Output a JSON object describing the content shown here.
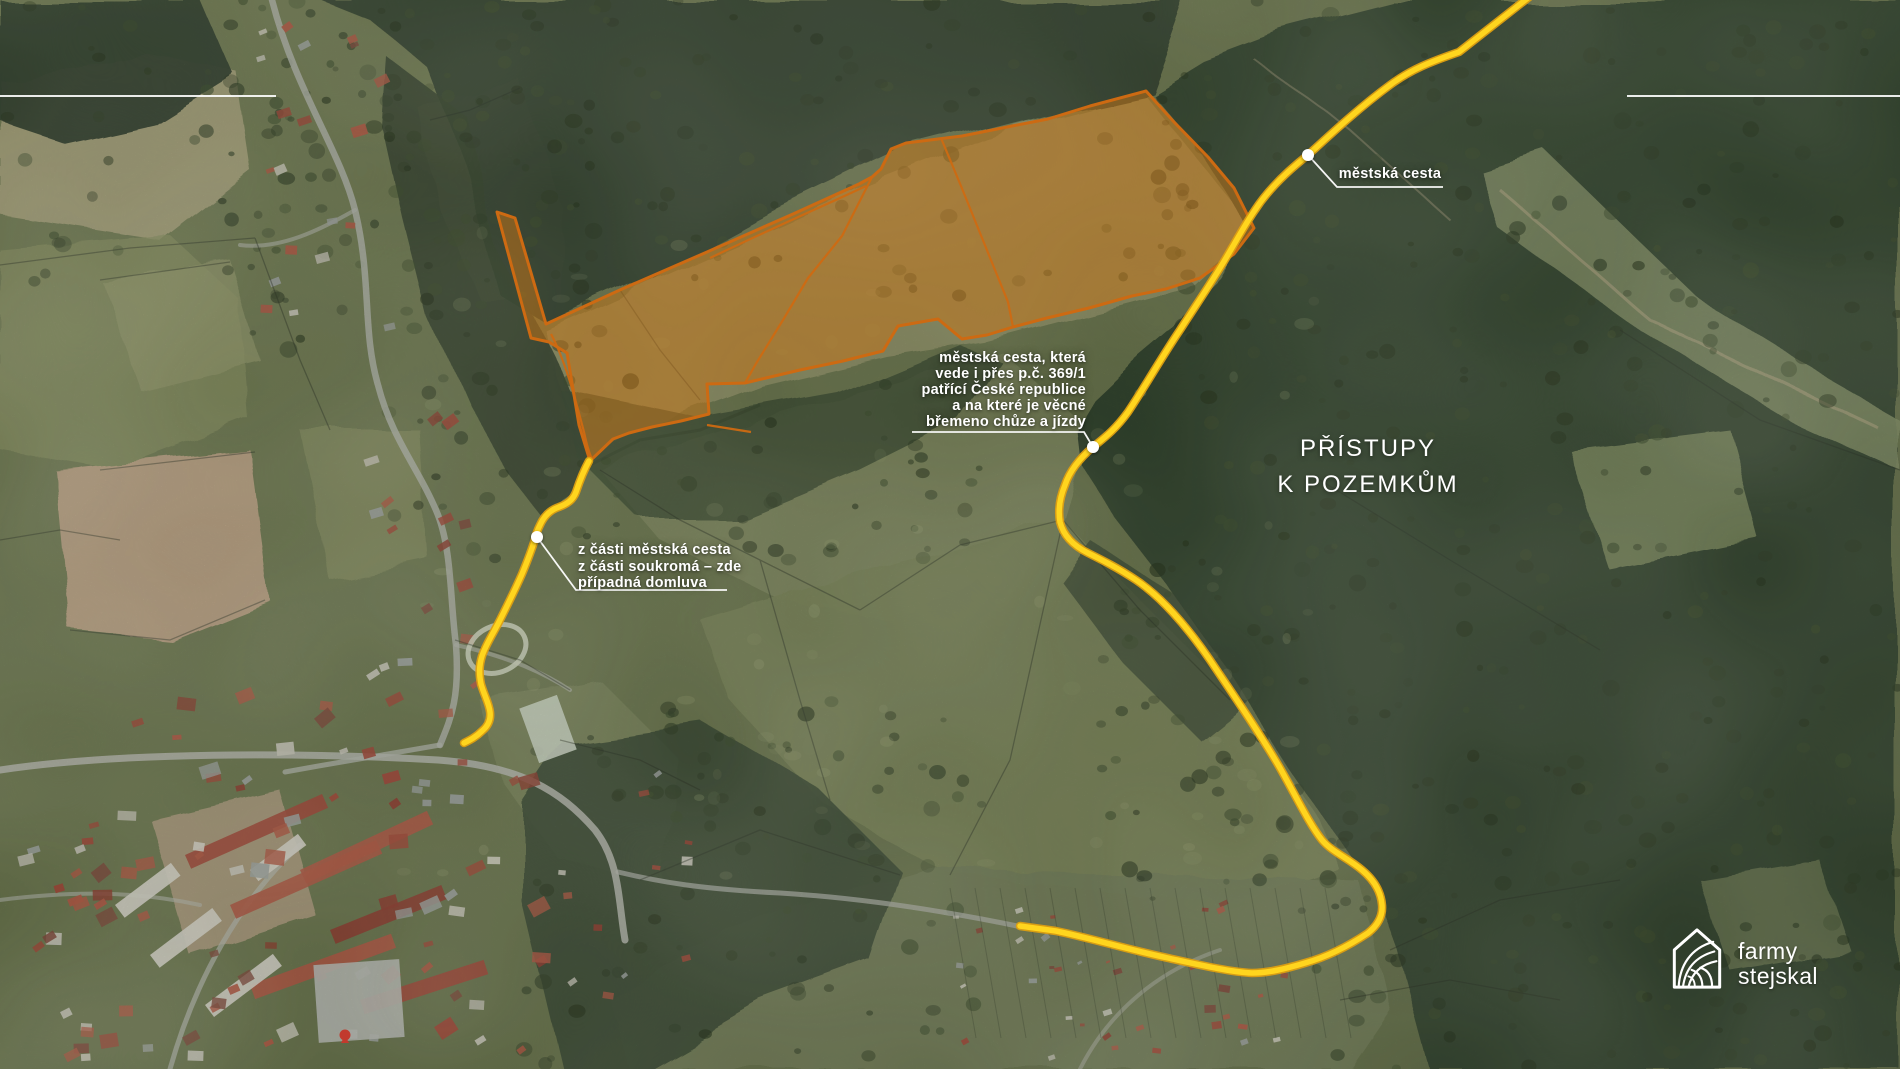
{
  "page": {
    "kind": "property-access-satellite-map"
  },
  "title": {
    "line1": "PŘÍSTUPY",
    "line2": "K POZEMKŮM"
  },
  "labels": {
    "road_top": "městská cesta",
    "easement_line1": "městská cesta, která",
    "easement_line2": "vede i přes p.č. 369/1",
    "easement_line3": "patřící České republice",
    "easement_line4": "a na které je věcné",
    "easement_line5": "břemeno chůze a jízdy",
    "partial_line1": "z části městská cesta",
    "partial_line2": "z části soukromá – zde",
    "partial_line3": "případná domluva"
  },
  "logo": {
    "name_line1": "farmy",
    "name_line2": "stejskal"
  },
  "colors": {
    "parcel_fill": "#C67417",
    "parcel_stroke": "#CD6A12",
    "route_yellow": "#FFD51E",
    "route_casing": "#DD9F12",
    "label_white": "#FFFFFF",
    "marker_red": "#E23B2C"
  }
}
